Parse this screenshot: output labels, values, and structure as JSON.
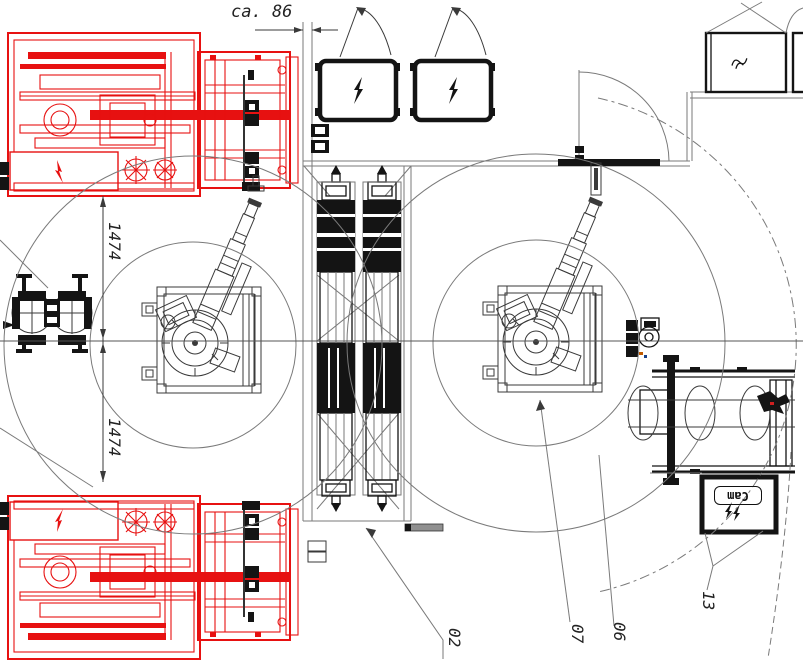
{
  "drawing": {
    "kind": "machine-layout-floorplan",
    "dimensions": {
      "gap_top": "ca. 86",
      "reach_upper": "1474",
      "reach_lower": "1474"
    },
    "callouts": {
      "conveyor": "02",
      "robot": "07",
      "fence": "06",
      "camera": "13"
    },
    "camera_box": {
      "label": "Cam"
    },
    "icons": {
      "electrical_box": "lightning-bolt-icon",
      "camera_flash": "double-lightning-icon",
      "utility_box": "wave-icon"
    },
    "colors": {
      "machine-red": "#e71111",
      "ink": "#141414",
      "gray": "#7a7a7a",
      "dim": "#3a3a3a"
    }
  }
}
